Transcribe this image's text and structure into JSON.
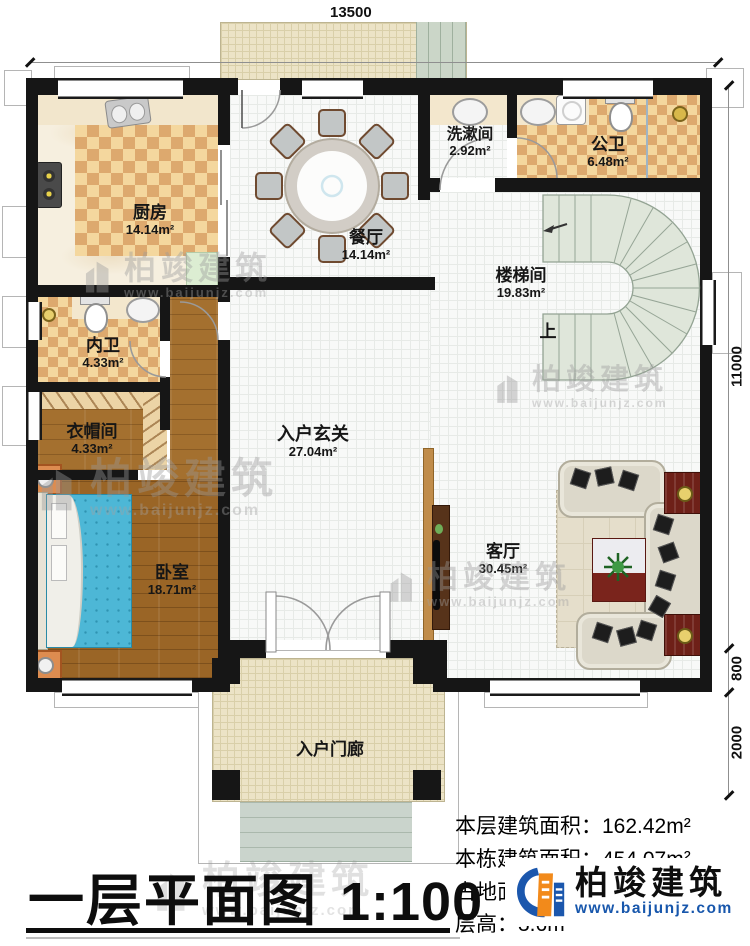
{
  "title": {
    "main": "一层平面图",
    "scale": "1:100"
  },
  "dims": {
    "top": "13500",
    "right_total": "11000",
    "right_800": "800",
    "right_2000": "2000"
  },
  "stair": {
    "up": "上"
  },
  "rooms": [
    {
      "id": "kitchen",
      "name": "厨房",
      "area": "14.14m²"
    },
    {
      "id": "dining",
      "name": "餐厅",
      "area": "14.14m²"
    },
    {
      "id": "washroom",
      "name": "洗漱间",
      "area": "2.92m²"
    },
    {
      "id": "public-bath",
      "name": "公卫",
      "area": "6.48m²"
    },
    {
      "id": "stairwell",
      "name": "楼梯间",
      "area": "19.83m²"
    },
    {
      "id": "inner-bath",
      "name": "内卫",
      "area": "4.33m²"
    },
    {
      "id": "cloakroom",
      "name": "衣帽间",
      "area": "4.33m²"
    },
    {
      "id": "foyer",
      "name": "入户玄关",
      "area": "27.04m²"
    },
    {
      "id": "bedroom",
      "name": "卧室",
      "area": "18.71m²"
    },
    {
      "id": "living",
      "name": "客厅",
      "area": "30.45m²"
    },
    {
      "id": "porch",
      "name": "入户门廊",
      "area": ""
    }
  ],
  "info": [
    {
      "label": "本层建筑面积：",
      "value": "162.42m²"
    },
    {
      "label": "本栋建筑面积：",
      "value": "454.07m²"
    },
    {
      "label": "占地面积：",
      "value": "147.51m²"
    },
    {
      "label": "层高：",
      "value": "3.6m"
    }
  ],
  "brand": {
    "name": "柏竣建筑",
    "url": "www.baijunjz.com"
  }
}
